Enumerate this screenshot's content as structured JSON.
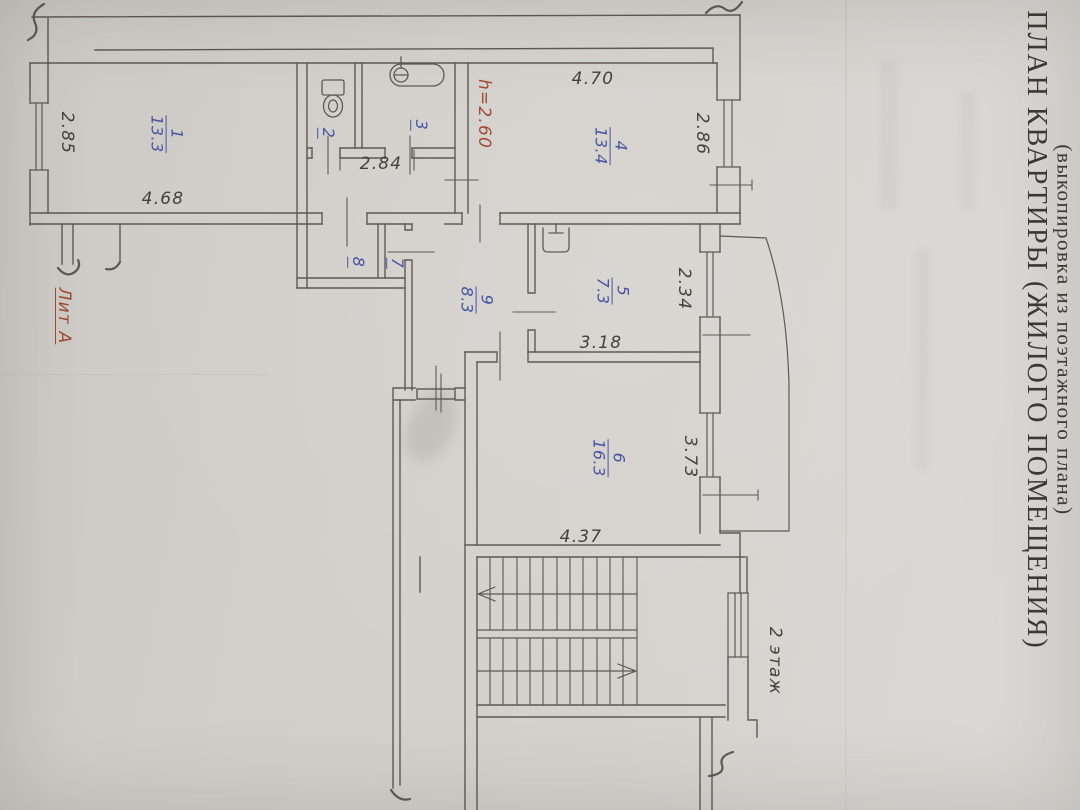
{
  "document": {
    "title": "ПЛАН КВАРТИРЫ (ЖИЛОГО ПОМЕЩЕНИЯ)",
    "subtitle": "(выкопировка из поэтажного плана)"
  },
  "colors": {
    "paper": "#d3d0cb",
    "ink": "#564f49",
    "blue_ink": "#4a55a2",
    "red_ink": "#a14a33",
    "pencil": "#45413b"
  },
  "icons": [
    "toilet-icon",
    "bathtub-icon",
    "sink-icon",
    "window-symbol",
    "staircase-icon",
    "stairs-up-arrow-icon",
    "stairs-down-arrow-icon",
    "balcony-outline",
    "wall-break-icon"
  ],
  "rooms": [
    {
      "number": "1",
      "area": "13.3"
    },
    {
      "number": "2",
      "area": ""
    },
    {
      "number": "3",
      "area": ""
    },
    {
      "number": "4",
      "area": "13.4"
    },
    {
      "number": "5",
      "area": "7.3"
    },
    {
      "number": "6",
      "area": "16.3"
    },
    {
      "number": "7",
      "area": ""
    },
    {
      "number": "8",
      "area": ""
    },
    {
      "number": "9",
      "area": "8.3"
    }
  ],
  "plan": {
    "room_labels": [
      {
        "id": "room-label-1",
        "num": "1",
        "den": "13.3",
        "x": 166,
        "y": 134
      },
      {
        "id": "room-label-2",
        "num": "2",
        "x": 326,
        "y": 133
      },
      {
        "id": "room-label-3",
        "num": "3",
        "x": 419,
        "y": 125
      },
      {
        "id": "room-label-4",
        "num": "4",
        "den": "13.4",
        "x": 610,
        "y": 146
      },
      {
        "id": "room-label-5",
        "num": "5",
        "den": "7.3",
        "x": 612,
        "y": 291
      },
      {
        "id": "room-label-6",
        "num": "6",
        "den": "16.3",
        "x": 608,
        "y": 458
      },
      {
        "id": "room-label-7",
        "num": "7",
        "x": 395,
        "y": 263
      },
      {
        "id": "room-label-8",
        "num": "8",
        "x": 356,
        "y": 262
      },
      {
        "id": "room-label-9",
        "num": "9",
        "den": "8.3",
        "x": 476,
        "y": 300
      }
    ],
    "dimensions": [
      {
        "id": "dim-2-85",
        "text": "2.85",
        "x": 67,
        "y": 133,
        "rot": 90
      },
      {
        "id": "dim-4-68",
        "text": "4.68",
        "x": 163,
        "y": 199,
        "rot": 0
      },
      {
        "id": "dim-2-84",
        "text": "2.84",
        "x": 381,
        "y": 164,
        "rot": 0
      },
      {
        "id": "dim-4-70",
        "text": "4.70",
        "x": 593,
        "y": 79,
        "rot": 0
      },
      {
        "id": "dim-2-86",
        "text": "2.86",
        "x": 702,
        "y": 134,
        "rot": 90
      },
      {
        "id": "dim-2-34",
        "text": "2.34",
        "x": 684,
        "y": 289,
        "rot": 90
      },
      {
        "id": "dim-3-18",
        "text": "3.18",
        "x": 601,
        "y": 343,
        "rot": 0
      },
      {
        "id": "dim-3-73",
        "text": "3.73",
        "x": 690,
        "y": 457,
        "rot": 90
      },
      {
        "id": "dim-4-37",
        "text": "4.37",
        "x": 581,
        "y": 537,
        "rot": 0
      }
    ],
    "notes": [
      {
        "id": "ceiling-height-note",
        "text": "h=2.60",
        "x": 484,
        "y": 114,
        "rot": 90,
        "cls": "red"
      },
      {
        "id": "liter-label",
        "text": "Лит А",
        "x": 64,
        "y": 316,
        "rot": 90,
        "cls": "red underline"
      },
      {
        "id": "floor-label",
        "text": "2 этаж",
        "x": 775,
        "y": 661,
        "rot": 90,
        "cls": ""
      }
    ]
  }
}
